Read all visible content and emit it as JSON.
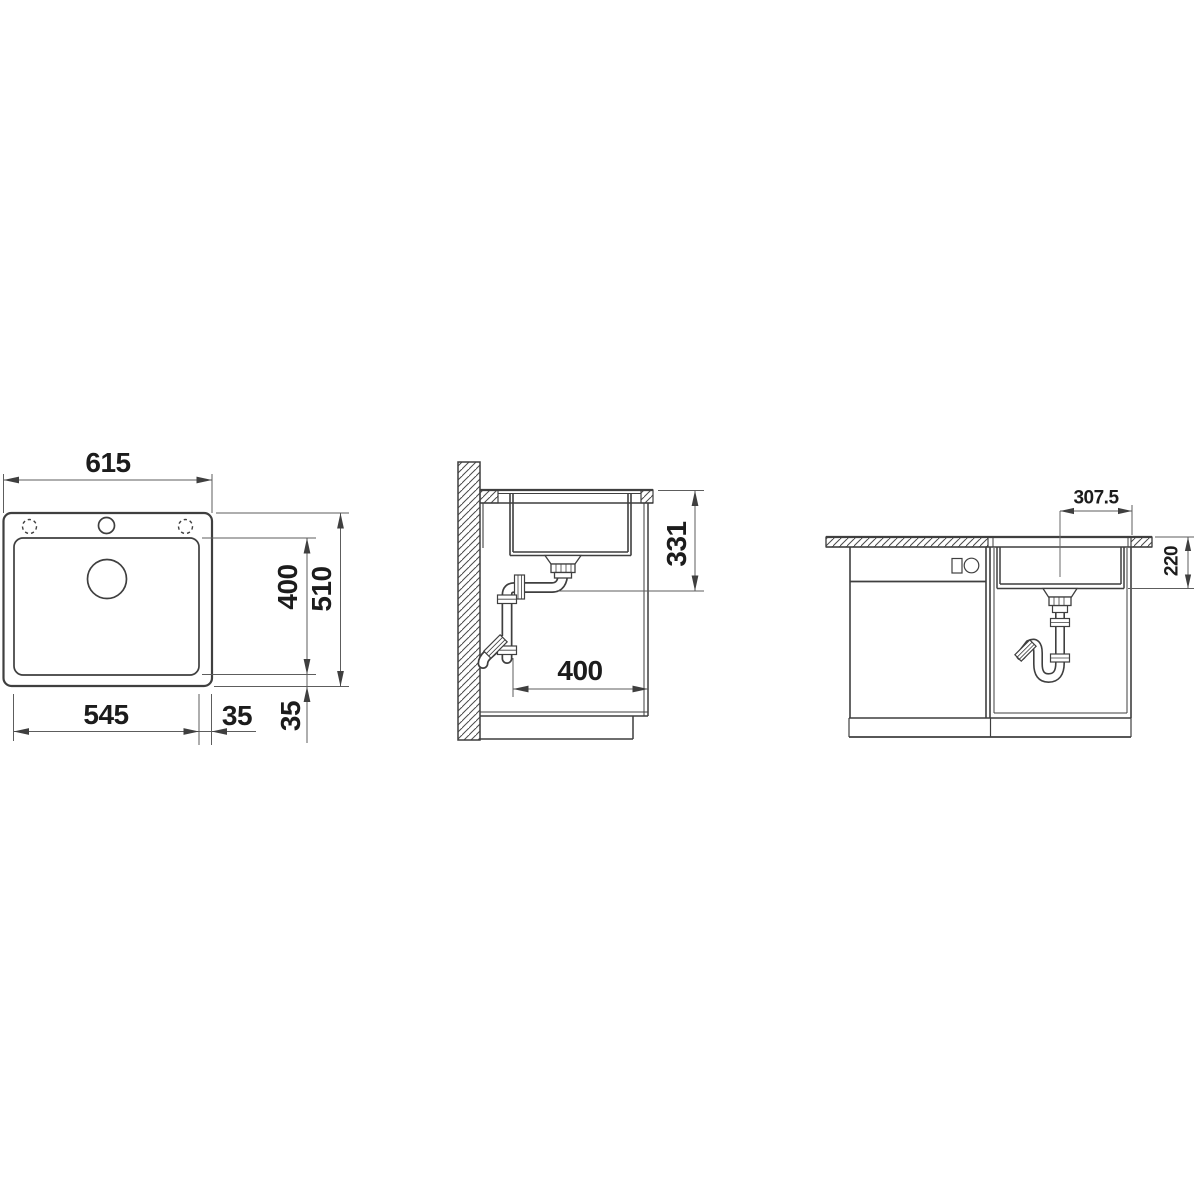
{
  "drawing": {
    "title": "Inset sink installation drawing (top view, side section, front view)",
    "line_color": "#3f3f3f",
    "dim_line_color": "#5d5d5d",
    "text_color": "#1c1c1c",
    "background": "#ffffff"
  },
  "top_view": {
    "overall_width": "615",
    "bowl_width": "545",
    "right_trim": "35",
    "bowl_depth": "400",
    "overall_depth": "510",
    "bottom_trim": "35"
  },
  "side_view": {
    "outlet_height": "331",
    "bowl_inner_depth": "400"
  },
  "front_view": {
    "center_to_edge": "307.5",
    "bowl_height": "220"
  }
}
